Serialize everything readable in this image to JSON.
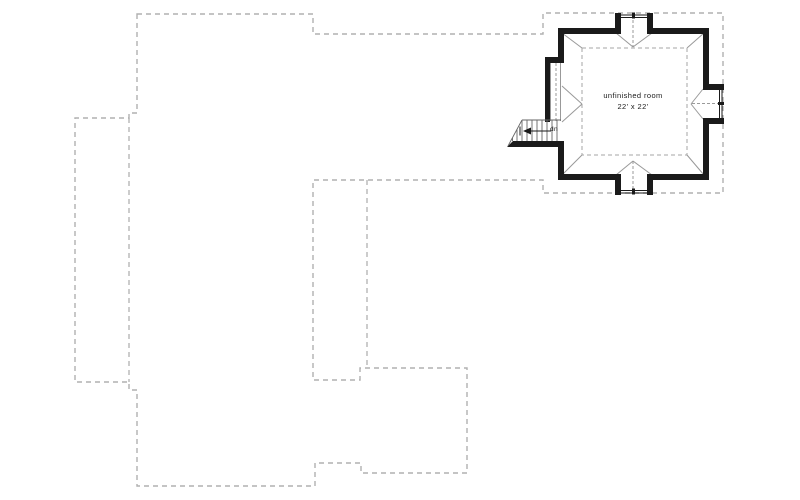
{
  "plan": {
    "room_label": "unfinished room",
    "room_dimensions": "22' x 22'",
    "stair_direction_label": "dn"
  },
  "colors": {
    "wall": "#1a1a1a",
    "dashed_outline": "#b0b0b0",
    "thin_line": "#999999",
    "background": "#ffffff"
  }
}
